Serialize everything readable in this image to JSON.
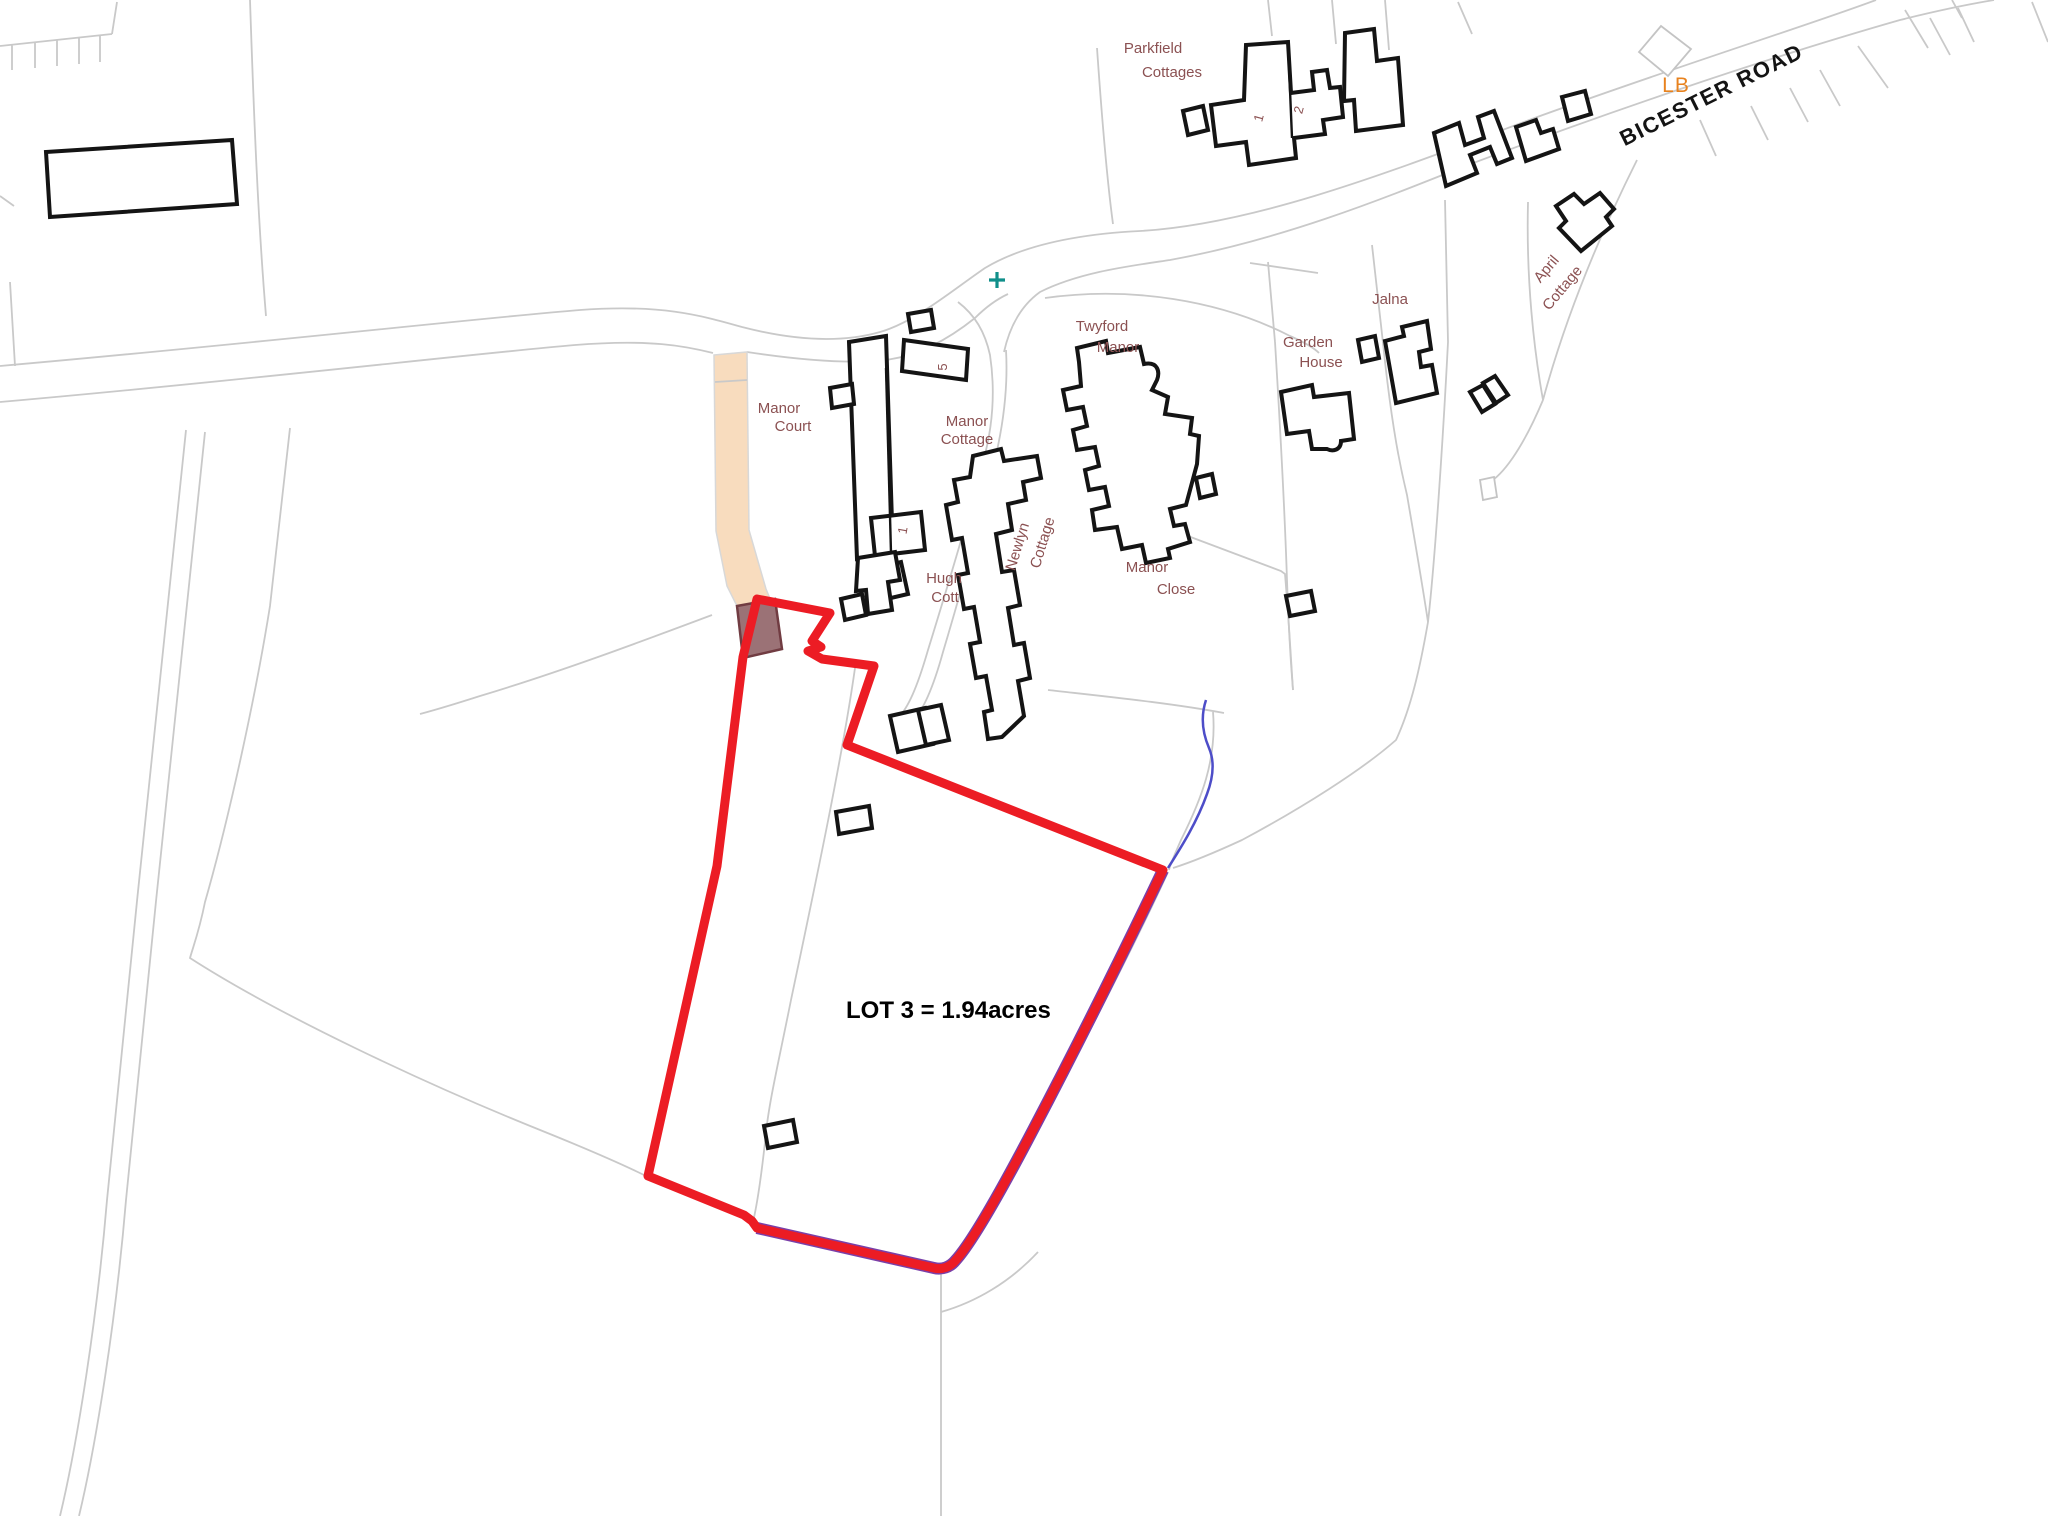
{
  "map": {
    "type": "site-plan",
    "lot": {
      "label": "LOT 3 = 1.94acres",
      "boundary_color": "#ec1c24"
    },
    "road": {
      "name": "BICESTER ROAD"
    },
    "markers": {
      "lb": "LB",
      "benchmark_cross": "+"
    },
    "properties": {
      "parkfield": {
        "line1": "Parkfield",
        "line2": "Cottages"
      },
      "twyford": {
        "line1": "Twyford",
        "line2": "Manor"
      },
      "manor_court": {
        "line1": "Manor",
        "line2": "Court"
      },
      "manor_cottage": {
        "line1": "Manor",
        "line2": "Cottage"
      },
      "hugh_cott": {
        "line1": "Hugh",
        "line2": "Cott"
      },
      "newlyn": {
        "line1": "Newlyn",
        "line2": "Cottage"
      },
      "manor_close": {
        "line1": "Manor",
        "line2": "Close"
      },
      "garden_house": {
        "line1": "Garden",
        "line2": "House"
      },
      "jalna": {
        "line1": "Jalna"
      },
      "april_cottage": {
        "line1": "April",
        "line2": "Cottage"
      }
    },
    "house_numbers": {
      "parkfield_1": "1",
      "parkfield_2": "2",
      "court_5": "5",
      "court_1": "1"
    },
    "colors": {
      "boundary_red": "#ec1c24",
      "label_brown": "#8b5152",
      "lb_orange": "#e8821e",
      "track_tan": "#f8dcbe",
      "building_fill_brown": "#9b7276",
      "stream_blue": "#4d4dc8",
      "stream_under_purple": "#7a3fa8",
      "cross_teal": "#108f8a",
      "parcel_gray": "#c9c9c9",
      "building_black": "#141414"
    }
  }
}
